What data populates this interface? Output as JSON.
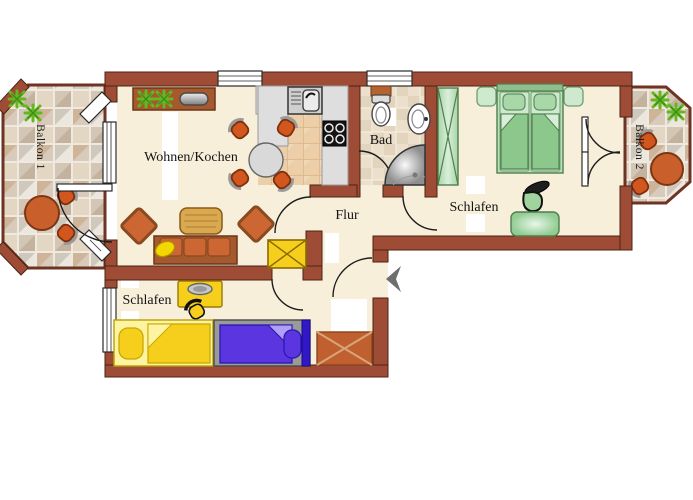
{
  "labels": {
    "living": "Wohnen/Kochen",
    "bath": "Bad",
    "hall": "Flur",
    "bedroom_main": "Schlafen",
    "bedroom_second": "Schlafen",
    "balcony_1": "Balkon 1",
    "balcony_2": "Balkon 2"
  },
  "colors": {
    "wall": "#9e4c36",
    "wall_edge": "#4a2313",
    "floor": "#f8efdb",
    "label": "#141414",
    "accent_orange": "#cc6633",
    "accent_orange_dark": "#7e3513",
    "wood": "#a5592e",
    "yellow": "#f6cf1d",
    "yellow_pale": "#fdf3a1",
    "purple": "#5a35e0",
    "purple_dark": "#2a18b0",
    "green": "#8cc88c",
    "green_pale": "#cfe9cf",
    "green_dark": "#4f7f4f",
    "gray_counter": "#dedede",
    "kitchen_tile": "#eccfa8",
    "bath_tile": "#ece0cc",
    "balcony_tile": "#d8ccbd",
    "plant_green": "#63b81e"
  }
}
